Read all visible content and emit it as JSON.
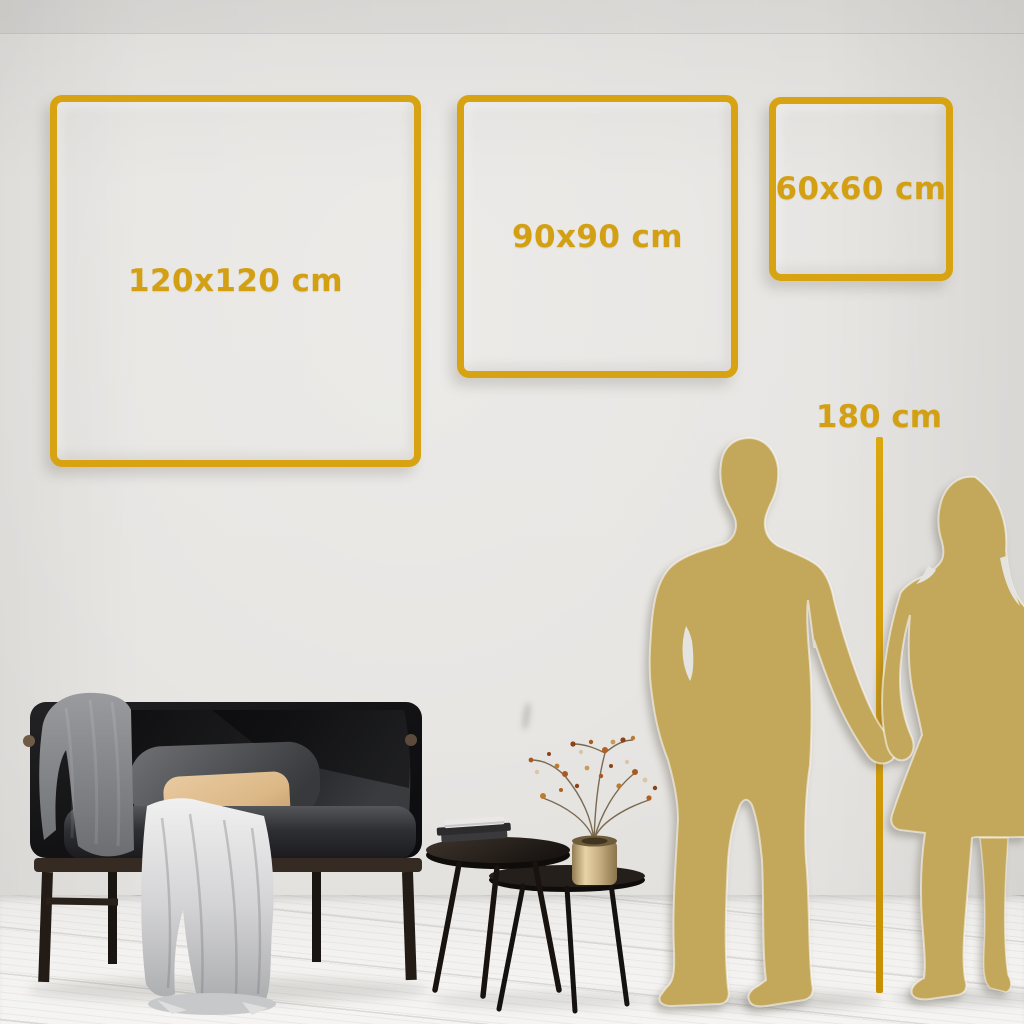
{
  "scene": {
    "type": "wall-art-size-guide",
    "setting": "living-room-wall",
    "squares": [
      {
        "id": "square-120",
        "label": "120x120 cm",
        "width_cm": 120,
        "height_cm": 120
      },
      {
        "id": "square-90",
        "label": "90x90 cm",
        "width_cm": 90,
        "height_cm": 90
      },
      {
        "id": "square-60",
        "label": "60x60 cm",
        "width_cm": 60,
        "height_cm": 60
      }
    ],
    "height_marker": {
      "label": "180 cm",
      "height_cm": 180
    },
    "colors": {
      "accent_gold": "#D7A313",
      "silhouette_gold": "#C3A75A",
      "wall": "#E6E4E1",
      "floor": "#F3F2F0",
      "sofa_dark": "#17171A",
      "pillow_tan": "#DDBC8C",
      "blanket_gray": "#9B9C9E",
      "table_wood": "#241F1B",
      "vase_brass": "#C9B184"
    },
    "figures": [
      "man-silhouette",
      "woman-silhouette"
    ],
    "furniture": [
      "sofa",
      "throw-blankets",
      "cushions",
      "nesting-coffee-tables",
      "books",
      "brass-vase-dried-flowers"
    ]
  }
}
